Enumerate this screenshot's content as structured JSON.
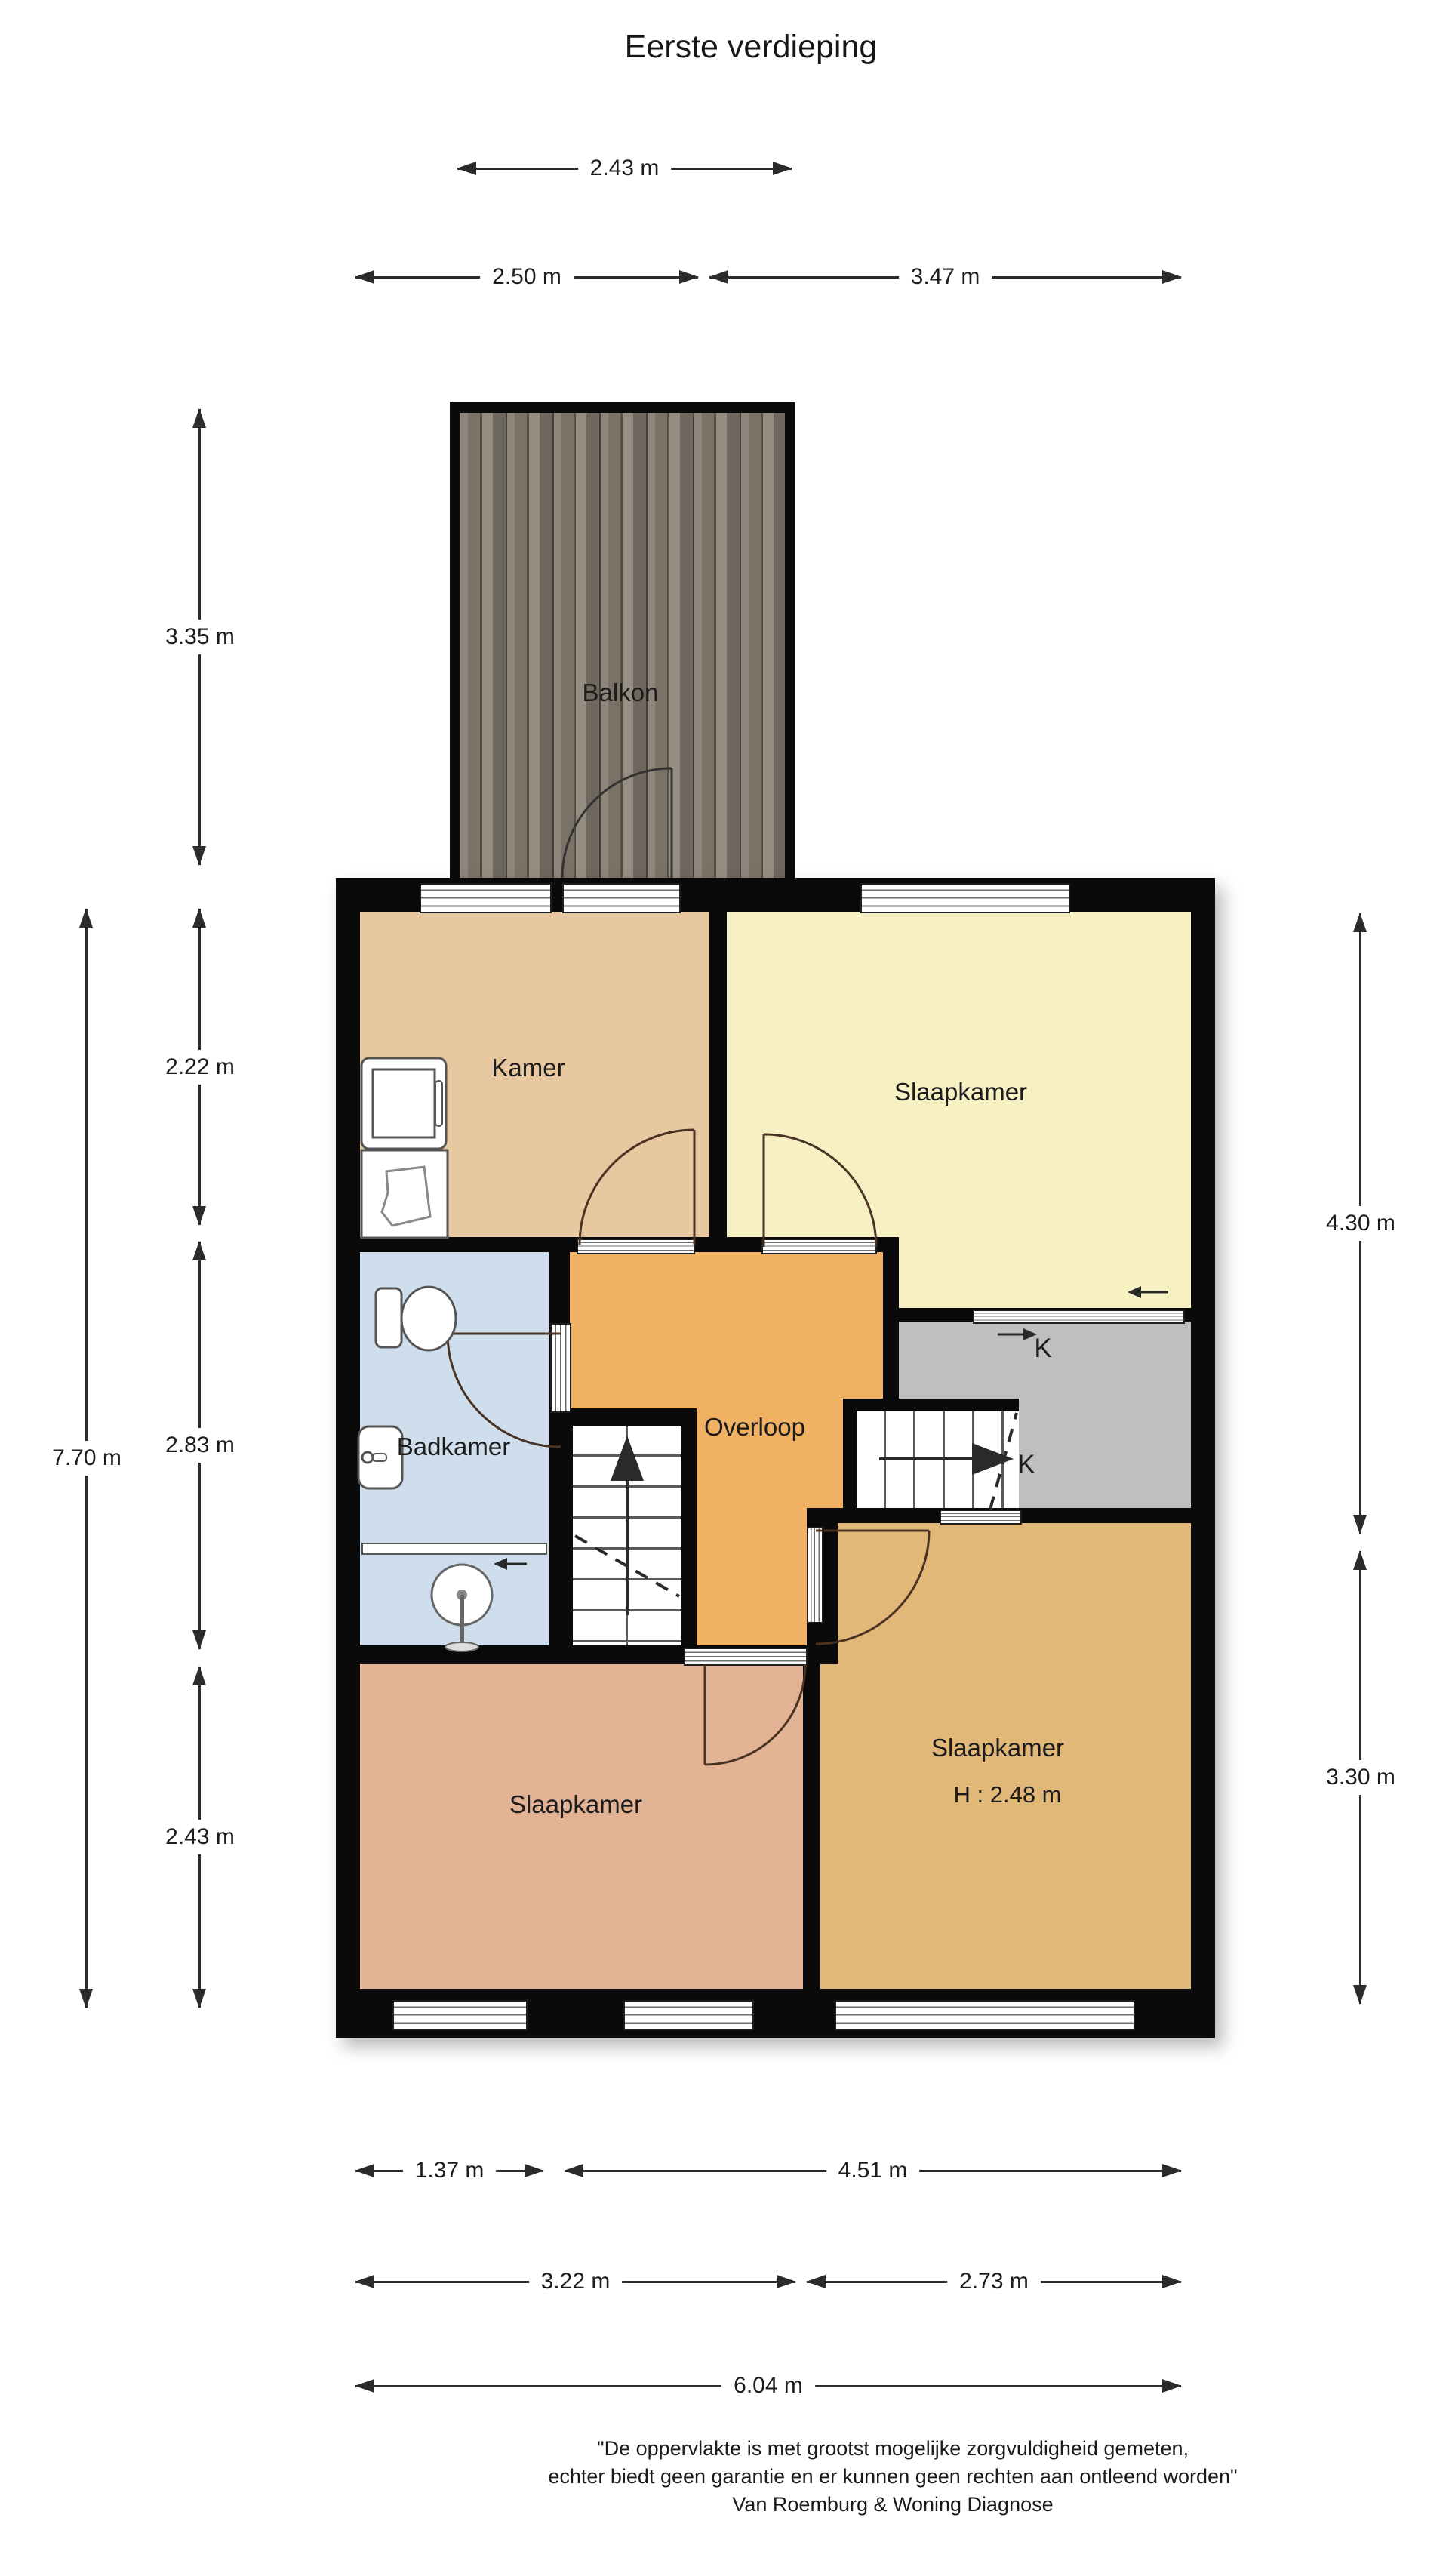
{
  "title": "Eerste verdieping",
  "rooms": {
    "balkon": "Balkon",
    "kamer": "Kamer",
    "slaapkamer_1": "Slaapkamer",
    "badkamer": "Badkamer",
    "overloop": "Overloop",
    "closet_1": "K",
    "closet_2": "K",
    "slaapkamer_2": "Slaapkamer",
    "slaapkamer_3": "Slaapkamer",
    "slaapkamer_3_height": "H : 2.48 m"
  },
  "dimensions": {
    "balkon_width": "2.43 m",
    "top_left": "2.50 m",
    "top_right": "3.47 m",
    "balkon_height": "3.35 m",
    "kamer_height": "2.22 m",
    "total_height_left": "7.70 m",
    "middle_height": "2.83 m",
    "bottom_height_left": "2.43 m",
    "right_upper": "4.30 m",
    "right_lower": "3.30 m",
    "bottom_row1_left": "1.37 m",
    "bottom_row1_right": "4.51 m",
    "bottom_row2_left": "3.22 m",
    "bottom_row2_right": "2.73 m",
    "bottom_total": "6.04 m"
  },
  "footer": {
    "line1": "\"De oppervlakte is met grootst mogelijke zorgvuldigheid gemeten,",
    "line2": "echter biedt geen garantie en er kunnen geen rechten aan ontleend worden\"",
    "line3": "Van Roemburg & Woning Diagnose"
  },
  "colors": {
    "wall": "#0a0a0a",
    "kamer": "#e8c8a0",
    "slaapkamer_yellow": "#f6f0c2",
    "badkamer": "#cfdeed",
    "overloop": "#f0b163",
    "closet": "#bfbfbf",
    "slaapkamer_salmon": "#e3b395",
    "slaapkamer_gold": "#e2b878",
    "balkon_wood_light": "#8f867b",
    "balkon_wood_dark": "#565047",
    "door": "#4a3322",
    "dim_line": "#2b2b2b"
  }
}
